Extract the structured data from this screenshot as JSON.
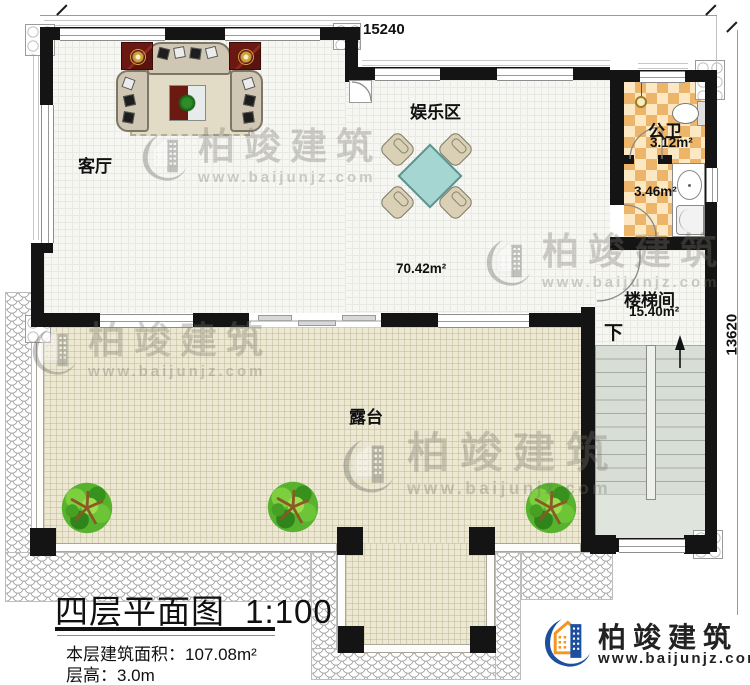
{
  "dimensions": {
    "top": "15240",
    "right": "13620"
  },
  "rooms": {
    "living": {
      "label": "客厅"
    },
    "entertainment": {
      "label": "娱乐区"
    },
    "public_bath": {
      "label": "公卫",
      "area": "3.12m²"
    },
    "bath_outer": {
      "area": "3.46m²"
    },
    "main_zone": {
      "area": "70.42m²"
    },
    "stairwell": {
      "label": "楼梯间",
      "area": "15.40m²",
      "direction": "下"
    },
    "terrace": {
      "label": "露台"
    }
  },
  "title_block": {
    "title": "四层平面图",
    "scale": "1:100",
    "area_label": "本层建筑面积：",
    "area_value": "107.08m²",
    "height_label": "层高：",
    "height_value": "3.0m"
  },
  "branding": {
    "name": "柏竣建筑",
    "website": "www.baijunjz.com"
  },
  "watermark": {
    "name": "柏竣建筑",
    "website": "www.baijunjz.com"
  },
  "colors": {
    "wall": "#141414",
    "bath_tile": "#edb569",
    "terrace_floor": "#ece8d3",
    "stair_floor": "#d8ded5",
    "logo_blue": "#1c4f9e",
    "logo_orange": "#f7941e"
  }
}
